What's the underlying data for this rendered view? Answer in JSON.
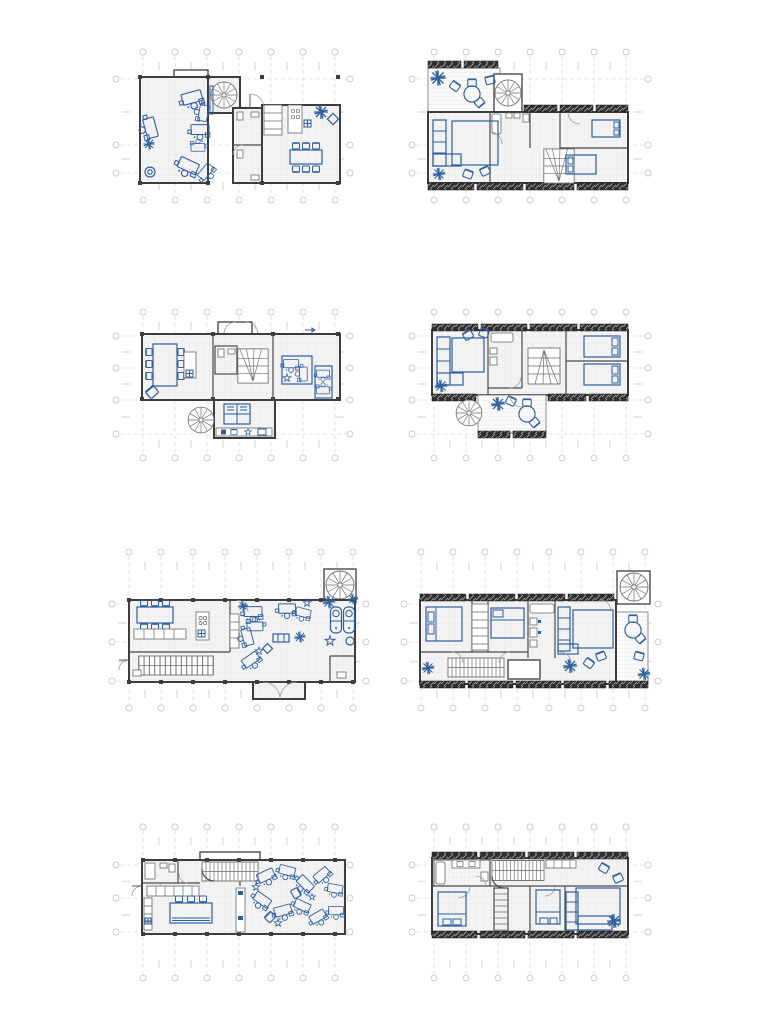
{
  "sheet": {
    "kind": "architectural-floor-plan-sheet",
    "plan_count": 8,
    "grid_layout": "2 columns by 4 rows",
    "plans": [
      {
        "id": "floor-plan-1",
        "position": "row-1-left",
        "depicts": [
          "spiral-stair",
          "kitchen",
          "dining-table",
          "bathrooms",
          "furniture-clusters"
        ]
      },
      {
        "id": "floor-plan-2",
        "position": "row-1-right",
        "depicts": [
          "roof-terrace",
          "spiral-stair",
          "sofa",
          "beds",
          "bathroom"
        ]
      },
      {
        "id": "floor-plan-3",
        "position": "row-2-left",
        "depicts": [
          "dining-table",
          "kitchen-island",
          "stairs",
          "spiral-stair",
          "workspace"
        ]
      },
      {
        "id": "floor-plan-4",
        "position": "row-2-right",
        "depicts": [
          "sofa",
          "bathroom",
          "stairs",
          "beds",
          "balcony",
          "spiral-stair",
          "round-table"
        ]
      },
      {
        "id": "floor-plan-5",
        "position": "row-3-left",
        "depicts": [
          "dining-table",
          "kitchen-island",
          "straight-stair",
          "spiral-stair",
          "workspace-clusters"
        ]
      },
      {
        "id": "floor-plan-6",
        "position": "row-3-right",
        "depicts": [
          "beds",
          "closet",
          "bathroom",
          "sofa",
          "terrace",
          "spiral-stair",
          "straight-stair"
        ]
      },
      {
        "id": "floor-plan-7",
        "position": "row-4-left",
        "depicts": [
          "bathroom",
          "straight-stair",
          "kitchen-counter",
          "long-table",
          "scattered-furniture"
        ]
      },
      {
        "id": "floor-plan-8",
        "position": "row-4-right",
        "depicts": [
          "bathroom",
          "straight-stair",
          "beds",
          "sofa",
          "plant"
        ]
      }
    ]
  },
  "colors": {
    "furn": "#2e5f9e",
    "wall": "#3d3d3d",
    "part": "#4a4a4a",
    "grid": "#dcdcdc",
    "gridb": "#c9c9c9",
    "stair": "#707070",
    "fixln": "#6a6a6a",
    "door": "#9a9a9a",
    "floorbg": "#f3f3f3",
    "floorln": "#e7e7e7",
    "deckbg": "#fafafa",
    "deckln": "#e5e5e5",
    "tilebg": "#f6f6f6",
    "tileln": "#e2e2e2",
    "hatchbg": "#2d2d2d",
    "hatchln": "#a0a0a0"
  }
}
